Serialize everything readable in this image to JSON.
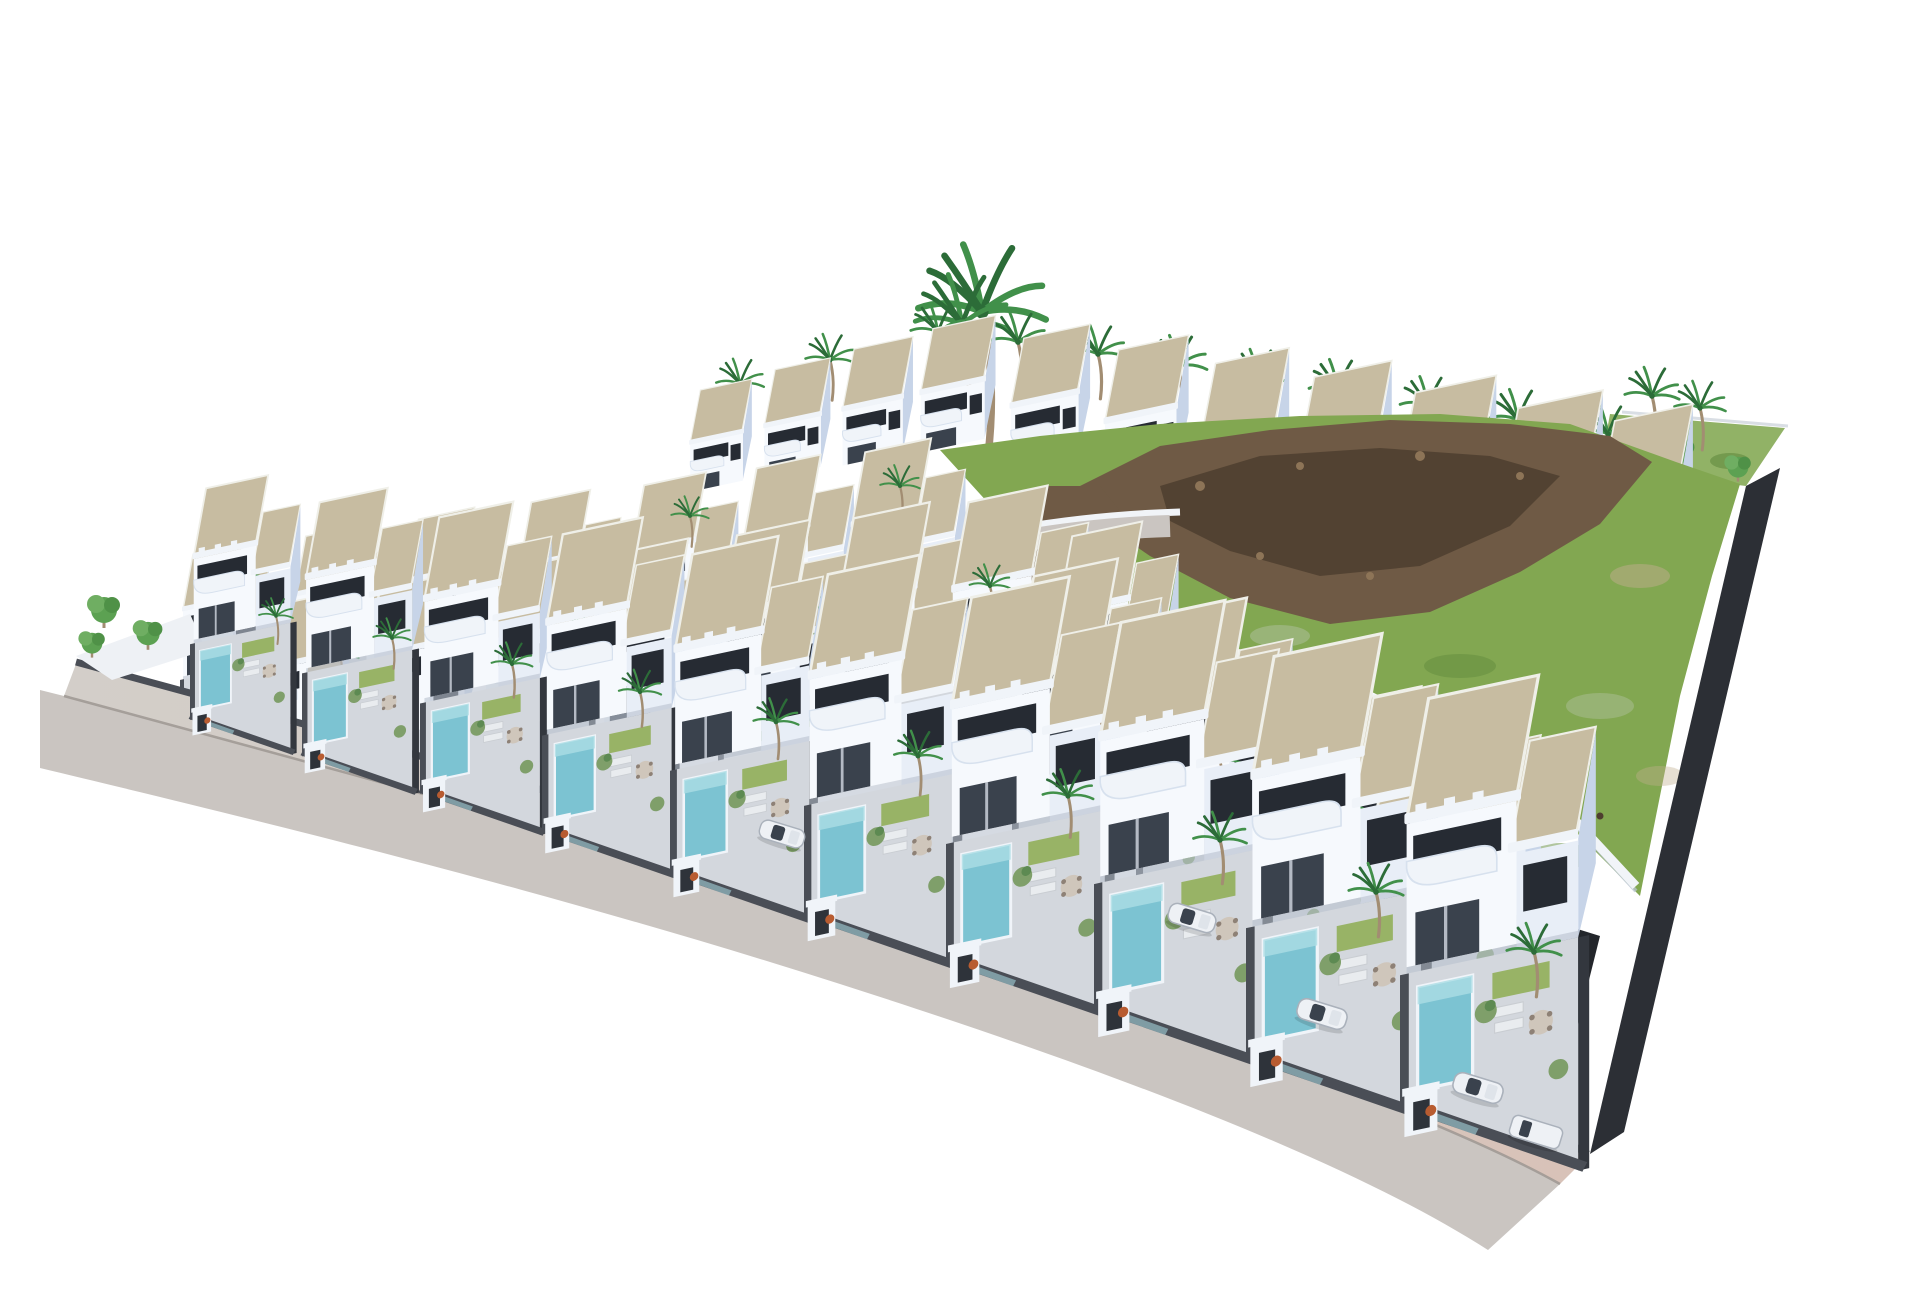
{
  "meta": {
    "title": "Aerial 3D architectural rendering of a hillside villa development with private pools, palm trees, a green slope with volcanic rock outcrops and a perimeter road, isolated on a white background",
    "image_type": "architectural-visualization"
  },
  "scene": {
    "background": "#ffffff",
    "villa_rows": {
      "front_row_along_road": 10,
      "inner_right_row": 4,
      "middle_row": 8,
      "back_row": 7,
      "far_top_row": 11
    },
    "features": {
      "private_pools": true,
      "roof_terraces": "tan gravel",
      "palm_trees_approx": 34,
      "parked_cars": 5,
      "hillside": "green scrub with brown volcanic rock ridge",
      "perimeter_road": "light gray with pink-beige sidewalk, lower left edge",
      "boundary": "dark gray walls and gravel strip on right edge"
    }
  },
  "colors": {
    "white": "#ffffff",
    "villaLight": "#f6f9fd",
    "villaFace": "#e8eef7",
    "villaShade": "#c7d4e8",
    "parapet": "#f0f4f9",
    "roofTan": "#c7bca1",
    "roofEdge": "#efefe8",
    "windowDark": "#262b33",
    "glass": "#3a424d",
    "wallDark": "#4a4e56",
    "wallDarker": "#33373e",
    "boundaryDark": "#2c2f35",
    "terrace": "#d3d7dd",
    "terraceWarm": "#cfc6bb",
    "pool": "#7cc3d2",
    "poolLight": "#abdde5",
    "lawn": "#92b05b",
    "hillGreen": "#82a751",
    "hillGreenDark": "#618b3d",
    "hillSage": "#a9bd92",
    "dirt": "#c0ae8e",
    "rock": "#6f5a45",
    "rockDark": "#4e3e2f",
    "rockLight": "#8d7457",
    "palmGreen": "#41904a",
    "palmDark": "#2c6c38",
    "trunk": "#a28d72",
    "treeGreen": "#5ca152",
    "road": "#cac5c1",
    "shoulderA": "#d3cec9",
    "shoulderB": "#d8c2b8",
    "curb": "#9a948e",
    "carWhite": "#eef1f5",
    "carGlass": "#3a424d"
  }
}
